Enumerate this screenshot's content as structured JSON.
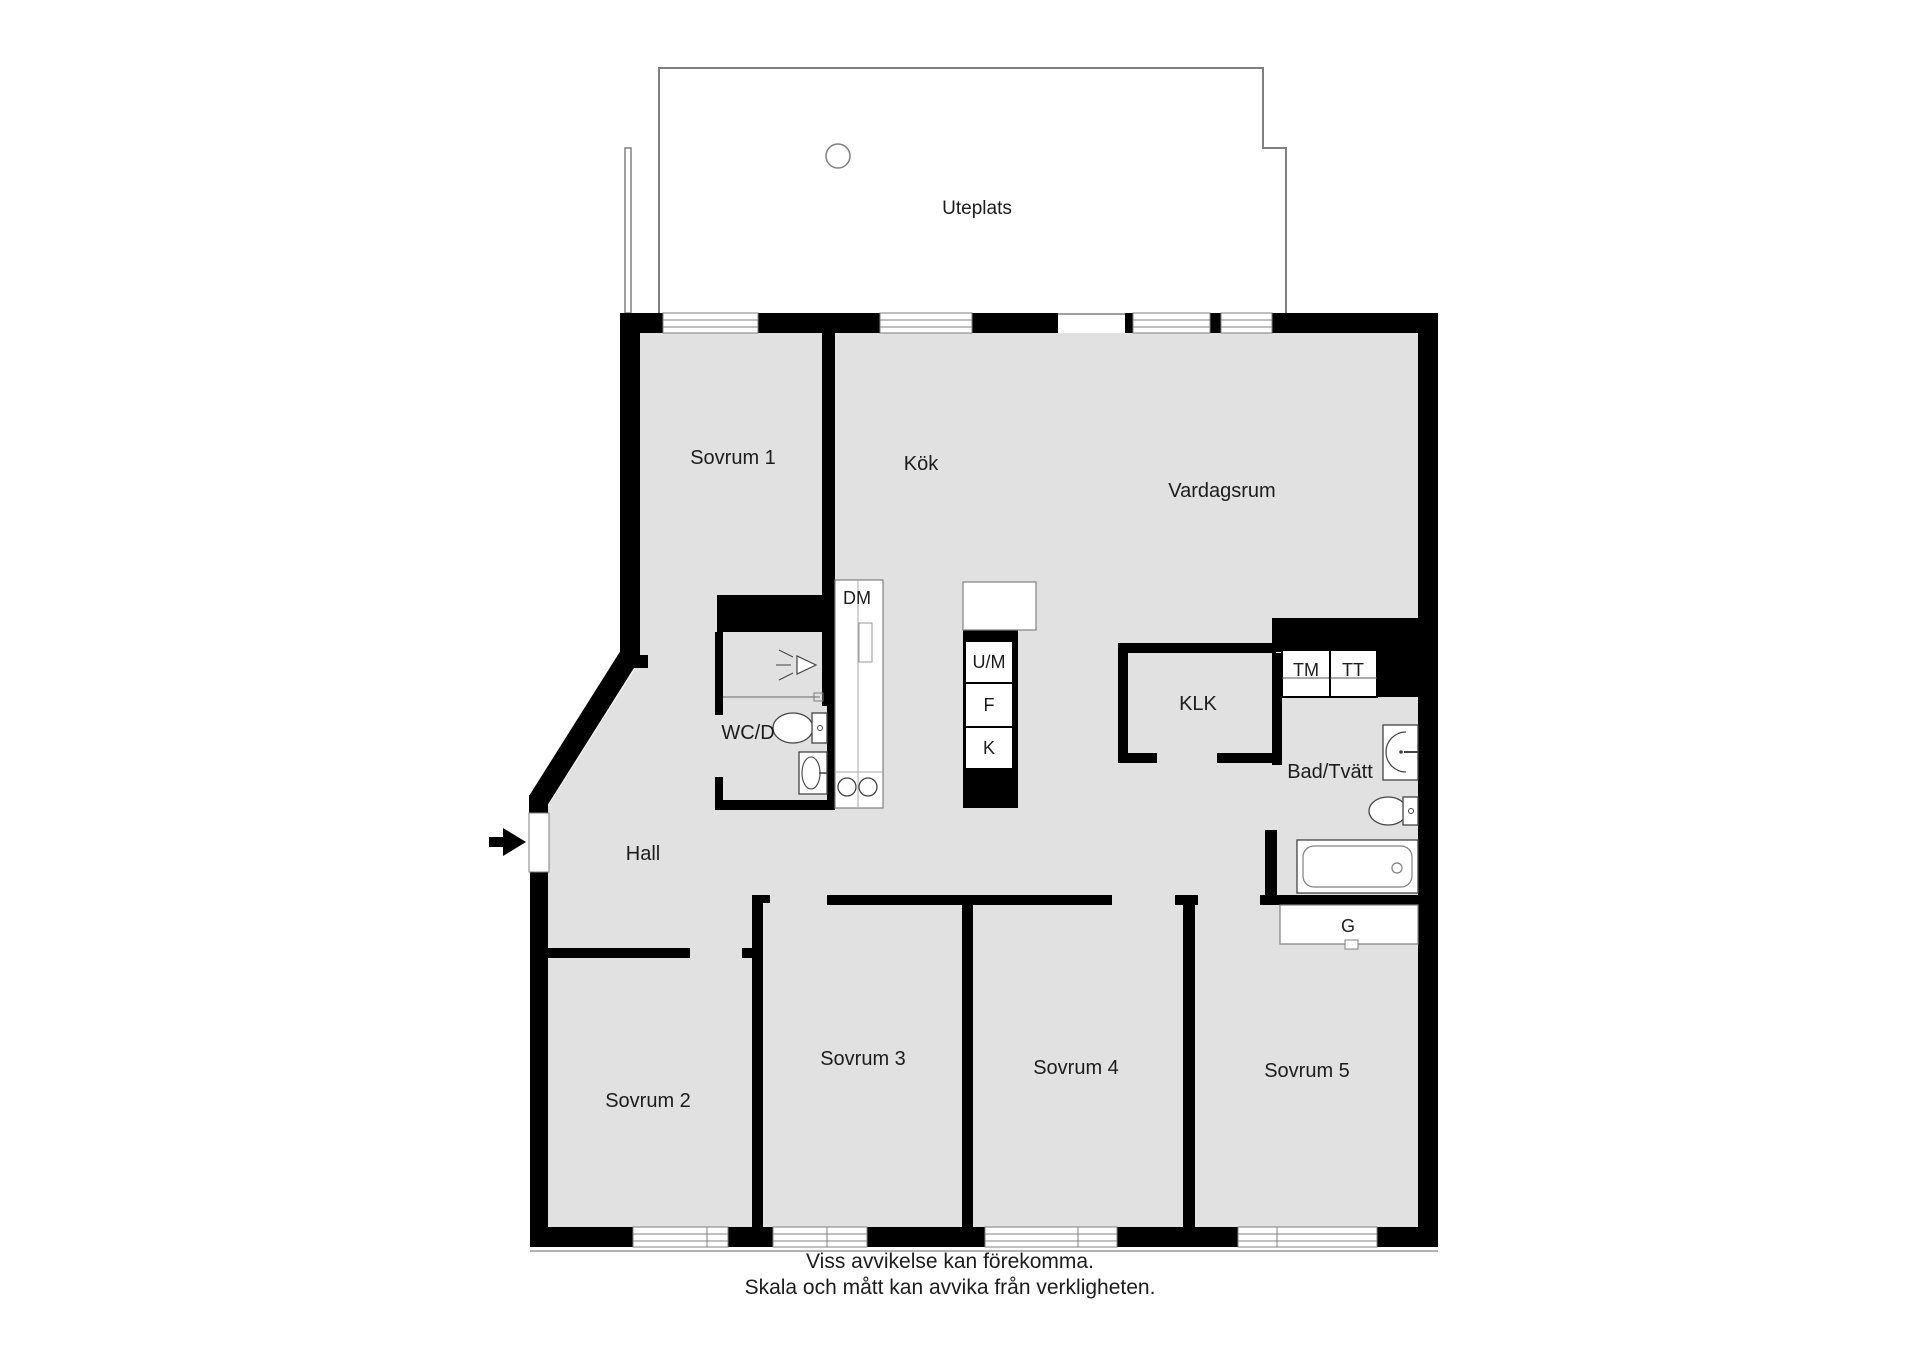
{
  "floorplan": {
    "outdoor": {
      "label": "Uteplats"
    },
    "rooms": [
      {
        "id": "sovrum1",
        "label": "Sovrum 1"
      },
      {
        "id": "kok",
        "label": "Kök"
      },
      {
        "id": "vardagsrum",
        "label": "Vardagsrum"
      },
      {
        "id": "wcd",
        "label": "WC/D"
      },
      {
        "id": "hall",
        "label": "Hall"
      },
      {
        "id": "klk",
        "label": "KLK"
      },
      {
        "id": "badtvatt",
        "label": "Bad/Tvätt"
      },
      {
        "id": "sovrum2",
        "label": "Sovrum 2"
      },
      {
        "id": "sovrum3",
        "label": "Sovrum 3"
      },
      {
        "id": "sovrum4",
        "label": "Sovrum 4"
      },
      {
        "id": "sovrum5",
        "label": "Sovrum 5"
      }
    ],
    "appliances": {
      "dm": "DM",
      "um": "U/M",
      "f": "F",
      "k": "K",
      "tm": "TM",
      "tt": "TT",
      "g": "G"
    },
    "disclaimer": {
      "line1": "Viss avvikelse kan förekomma.",
      "line2": "Skala och mått kan avvika från verkligheten."
    },
    "colors": {
      "wall": "#000000",
      "floor": "#e1e1e1",
      "fixture_outline": "#444444",
      "thin_line": "#808080",
      "text": "#1c1c1c"
    }
  }
}
